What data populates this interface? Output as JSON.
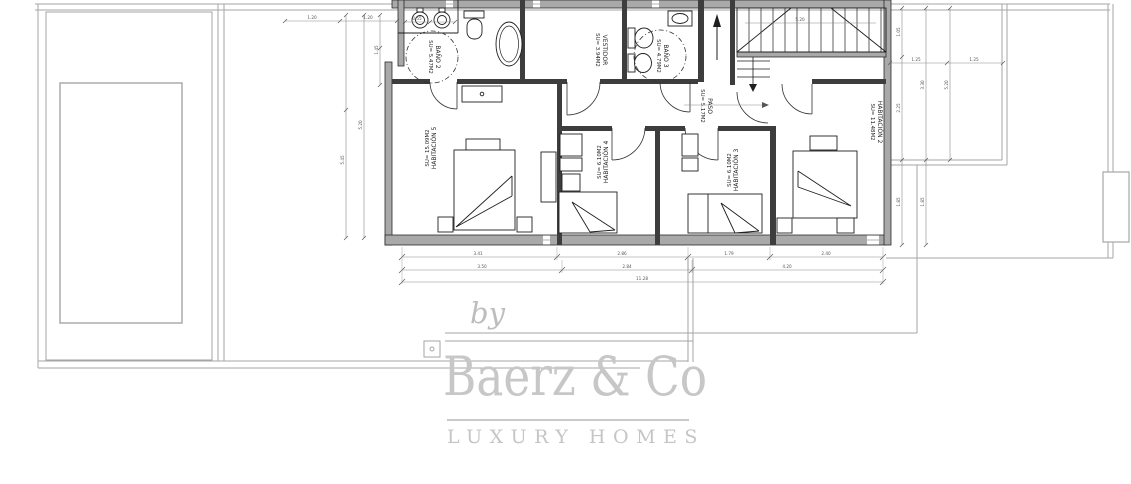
{
  "watermark": {
    "by": "by",
    "brand": "Baerz & Co",
    "tagline": "LUXURY HOMES"
  },
  "rooms": {
    "bano2": {
      "name": "BAÑO 2",
      "area": "SU= 5.47M2"
    },
    "vestidor": {
      "name": "VESTIDOR",
      "area": "SU= 3.94M2"
    },
    "bano3": {
      "name": "BAÑO 3",
      "area": "SU= 4.79M2"
    },
    "paso": {
      "name": "PASO",
      "area": "SU= 5.17M2"
    },
    "hab2": {
      "name": "HABITACIÓN 2",
      "area": "SU= 11.48M2"
    },
    "hab3": {
      "name": "HABITACIÓN 3",
      "area": "SU= 6.10M2"
    },
    "hab4": {
      "name": "HABITACIÓN 4",
      "area": "SU= 6.10M2"
    },
    "hab5": {
      "name": "HABITACIÓN 5",
      "area": "SU= 15.09M2"
    }
  },
  "dims": {
    "b1": "3.41",
    "b2": "2.86",
    "b3": "1.79",
    "b4": "2.40",
    "b5": "3.50",
    "b6": "2.84",
    "b7": "4.20",
    "b8": "11.28",
    "l1": "1.45",
    "l2": "5.20",
    "l3": "5.45",
    "t1": "1.20",
    "t2": "1.20",
    "t3": "0.55",
    "r1": "1.05",
    "r2": "2.25",
    "r3": "1.85",
    "r4": "3.30",
    "r5": "1.85",
    "r6": "5.20",
    "r7": "1.25",
    "r8": "1.25",
    "s1": "5.20"
  },
  "colors": {
    "wall_fill": "#a9a9a9",
    "partition_fill": "#3d3d3d",
    "line_dark": "#2a2a2a",
    "site_line": "#a6a6a6",
    "watermark_gray": "#c7c7c7"
  }
}
